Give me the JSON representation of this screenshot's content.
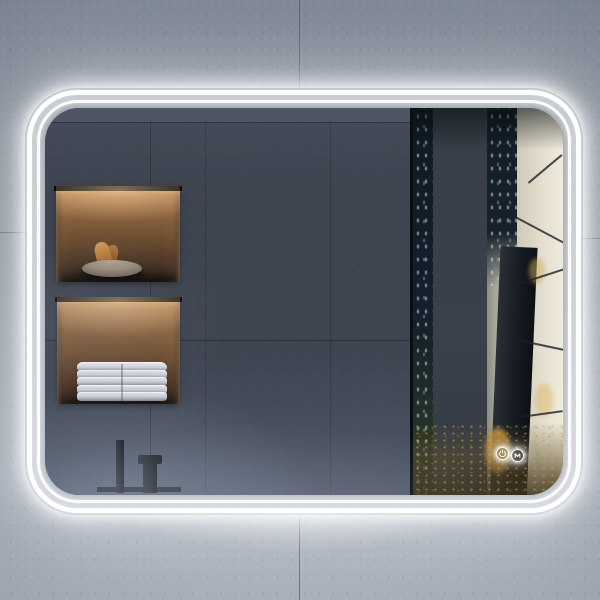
{
  "scene": {
    "description": "Backlit LED bathroom mirror with double light ring and rounded corners, mounted on a grey concrete tile wall",
    "reflection": {
      "wall": "dark slate large-format tiles",
      "niche_top": {
        "label": "recessed wall niche with warm light",
        "item": "stone bowl with dried botanicals"
      },
      "niche_bottom": {
        "label": "recessed wall niche with warm light",
        "item": "stack of folded towels",
        "towel_count": 5
      },
      "fixture": "matte black basin faucet",
      "view": "foggy forest with dark tree trunks and autumn leaves"
    },
    "touch_controls": [
      {
        "id": "power",
        "label": "Power light toggle",
        "icon": "power-icon"
      },
      {
        "id": "defog",
        "label": "Anti-fog toggle",
        "icon": "defog-icon"
      }
    ],
    "palette": {
      "led": "#ffffff",
      "wall": "#8b95a1",
      "wall_bottom": "#adb4be",
      "reflection_wall": "#3e4450",
      "niche_glow": "#d7a36b",
      "niche_shadow": "#271b13",
      "towel": "#d9dce2",
      "bowl": "#a3988a",
      "botanical": "#c08447",
      "faucet": "#101418",
      "forest_mist": "#e6e2d4",
      "forest_trunk": "#14202b",
      "autumn_leaf": "#d7a43c"
    }
  }
}
